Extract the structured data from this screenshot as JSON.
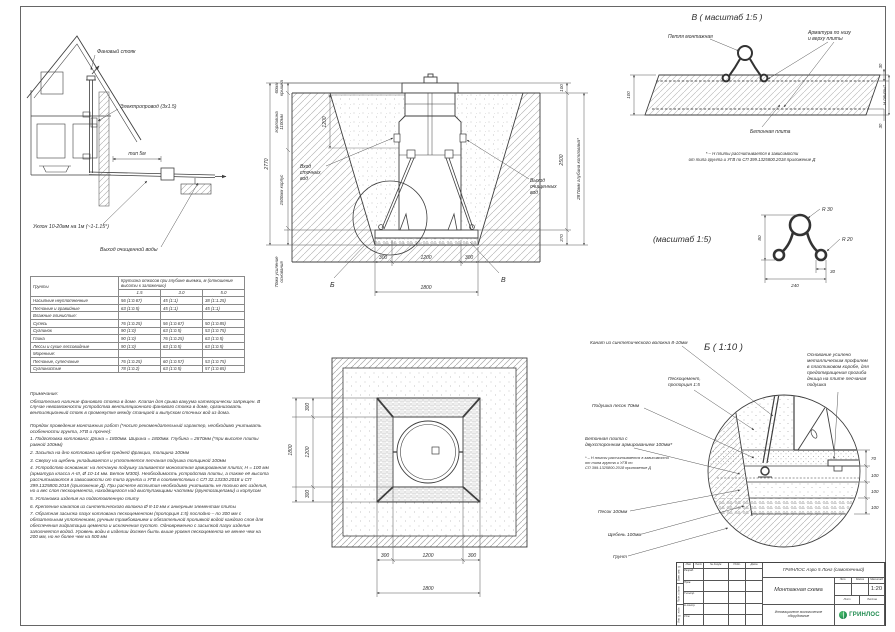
{
  "house": {
    "fan_stack": "Фановый стояк",
    "wire": "Электропровод (3х1.5)",
    "dist": "тип 5м",
    "slope": "Уклон 10-20мм на 1м (~1-1.15°)",
    "water_out": "Выход очищенной воды"
  },
  "section": {
    "cover_l1": "60мм",
    "cover_l2": "крышка",
    "neck_l1": "горловина",
    "neck_l2": "1100мм",
    "body": "1500мм корпус",
    "base_l1": "70мм усиление",
    "base_l2": "основания",
    "total_left": "2770",
    "neck_dim": "1200",
    "d100": "100",
    "d2500": "2500",
    "d370": "370",
    "depth": "2870мм глубина котлована*",
    "inlet_l1": "Вход",
    "inlet_l2": "сточных",
    "inlet_l3": "вод",
    "outlet_l1": "Выход",
    "outlet_l2": "очищенных",
    "outlet_l3": "вод",
    "b300l": "300",
    "b1200": "1200",
    "b300r": "300",
    "b1800": "1800",
    "callout_b": "Б",
    "callout_v": "В"
  },
  "detail_v": {
    "title": "В ( масштаб 1:5 )",
    "loop_label": "Петля монтажная",
    "rebar_l1": "Арматура по низу",
    "rebar_l2": "и верху плиты",
    "slab_label": "Бетонная плита",
    "d100": "100",
    "d30t": "30",
    "d30b": "30",
    "dh": "Н плиты*",
    "fn1": "* – Н плиты рассчитывается в зависимости",
    "fn2": "от типа грунта и УГВ по СП 399.1325800.2018 приложение Д"
  },
  "detail_loop": {
    "title": "(масштаб 1:5)",
    "r30": "R 30",
    "r20": "R 20",
    "d80": "80",
    "d30": "30",
    "d240": "240"
  },
  "detail_b": {
    "title": "Б ( 1:10 )",
    "rope": "Канат из синтетического волокна 8-10мм",
    "pesco_l1": "Пескоцемент,",
    "pesco_l2": "пропорция 1:5",
    "cushion": "Подушка песок 70мм",
    "slab_l1": "Бетонная плита с",
    "slab_l2": "двухсторонним армированием 100мм*",
    "fn1": "* – Н плиты рассчитывается в зависимости",
    "fn2": "от типа грунта и УГВ по",
    "fn3": "СП 399.1325800.2018 приложение Д",
    "sand": "Песок 100мм",
    "gravel": "Щебень 100мм",
    "soil": "Грунт",
    "note_l1": "Основание усилено",
    "note_l2": "металлическим профилем",
    "note_l3": "в пластиковом коробе, для",
    "note_l4": "предотвращения прогиба",
    "note_l5": "днища на плите песчаная",
    "note_l6": "подушка",
    "d70": "70",
    "d100a": "100",
    "d100b": "100",
    "d100c": "100"
  },
  "plan": {
    "l300t": "300",
    "l1200": "1200",
    "l300b": "300",
    "l1800": "1800",
    "b300l": "300",
    "b1200": "1200",
    "b300r": "300",
    "b1800": "1800"
  },
  "table": {
    "col_soil": "Грунты",
    "col_main": "Крутизна откосов при глубине выемки, м (отношение высоты к заложению)",
    "cols": [
      "1.5",
      "3.0",
      "5.0"
    ],
    "rows": [
      {
        "n": "Насыпные неуплотненные",
        "v": [
          "56 (1:0.67)",
          "45 (1:1)",
          "38 (1:1.25)"
        ]
      },
      {
        "n": "Песчаные и гравийные",
        "v": [
          "63 (1:0.5)",
          "45 (1:1)",
          "45 (1:1)"
        ]
      },
      {
        "n": "Влажные глинистые:",
        "v": [
          "",
          "",
          ""
        ]
      },
      {
        "n": "Супесь",
        "v": [
          "76 (1:0.25)",
          "56 (1:0.67)",
          "50 (1:0.85)"
        ]
      },
      {
        "n": "Суглинок",
        "v": [
          "90 (1:0)",
          "63 (1:0.5)",
          "53 (1:0.75)"
        ]
      },
      {
        "n": "Глина",
        "v": [
          "90 (1:0)",
          "76 (1:0.25)",
          "63 (1:0.5)"
        ]
      },
      {
        "n": "Лессы и сухие лессовидные",
        "v": [
          "90 (1:0)",
          "63 (1:0.5)",
          "63 (1:0.5)"
        ]
      },
      {
        "n": "Моренные:",
        "v": [
          "",
          "",
          ""
        ]
      },
      {
        "n": "Песчаные, супесчаные",
        "v": [
          "76 (1:0.25)",
          "60 (1:0.57)",
          "53 (1:0.75)"
        ]
      },
      {
        "n": "Суглинистые",
        "v": [
          "78 (1:0.2)",
          "63 (1:0.5)",
          "57 (1:0.65)"
        ]
      }
    ]
  },
  "notes": {
    "paras": [
      "Примечание:",
      "Обязательно наличие фанового стояка в доме. Клапан для срыва вакуума категорически запрещен. В случае невозможности устройства вентиляционного фанового стояка в доме, организовать вентиляционный стояк в промежутке между станцией и выпуском сточных вод из дома.",
      "Порядок проведения монтажных работ (*носит рекомендательный характер, необходимо учитывать особенности грунта, УГВ и прочее):",
      "1. Подготовка котлована: Длина = 1800мм. Ширина = 1800мм. Глубина = 2870мм (*при высоте плиты равной 100мм)",
      "2. Засыпка на дно котлована щебня средней фракции, толщина 100мм",
      "3. Сверху на щебень укладывается и уплотняется песчаная подушка толщиной 100мм",
      "4. Устройство основания: на песчаную подушку заливается монолитная армированная плита; Н = 100 мм (арматура класса А-III, Ø 10-14 мм. Бетон М300). Необходимость устройства плиты, а также её высота рассчитываются в зависимости от типа грунта и УГВ в соответствии с СП 32.13330.2018 и СП 399.1325800.2018 (приложение Д). При расчете всплытия необходимо учитывать не только вес изделия, но и вес слоя пескоцемента, находящегося над выступающими частями (грунтозацепами) и корпусом",
      "5. Установка изделия на подготовленную плиту",
      "6. Крепление канатов из синтетического волокна Ø 8-10 мм к анкерным элементам плиты",
      "7. Обратная засыпка пазух котлована пескоцементом (пропорция 1:5) послойно – по 300 мм с обязательным уплотнением, ручным трамбованием и обязательной проливкой водой каждого слоя для обеспечения гидратации цемента и исключения пустот. Одновременно с засыпкой пазух изделие заполняется водой. Уровень воды в изделии должен быть выше уровня пескоцемента не менее чем на 200 мм, но не более чем на 500 мм"
    ]
  },
  "titleblock": {
    "doc_name": "ГРИНЛОС Аэро 5 Лонг (самотечный)",
    "sheet_name": "Монтажная схема",
    "scale_value": "1:20",
    "tagline": "Инновационное экологическое оборудование",
    "brand": "ГРИНЛОС",
    "hdr": [
      "Изм.",
      "Лист",
      "№ докум.",
      "Подп.",
      "Дата"
    ],
    "rows": [
      "Разраб.",
      "Пров.",
      "Т.контр.",
      "Н.контр.",
      "Утв."
    ],
    "lit": "Лит.",
    "mass": "Масса",
    "msh": "Масштаб",
    "list": "Лист",
    "listov": "Листов",
    "side": [
      "Взам. инв. №",
      "Подп. и дата",
      "Инв. № подл."
    ]
  }
}
